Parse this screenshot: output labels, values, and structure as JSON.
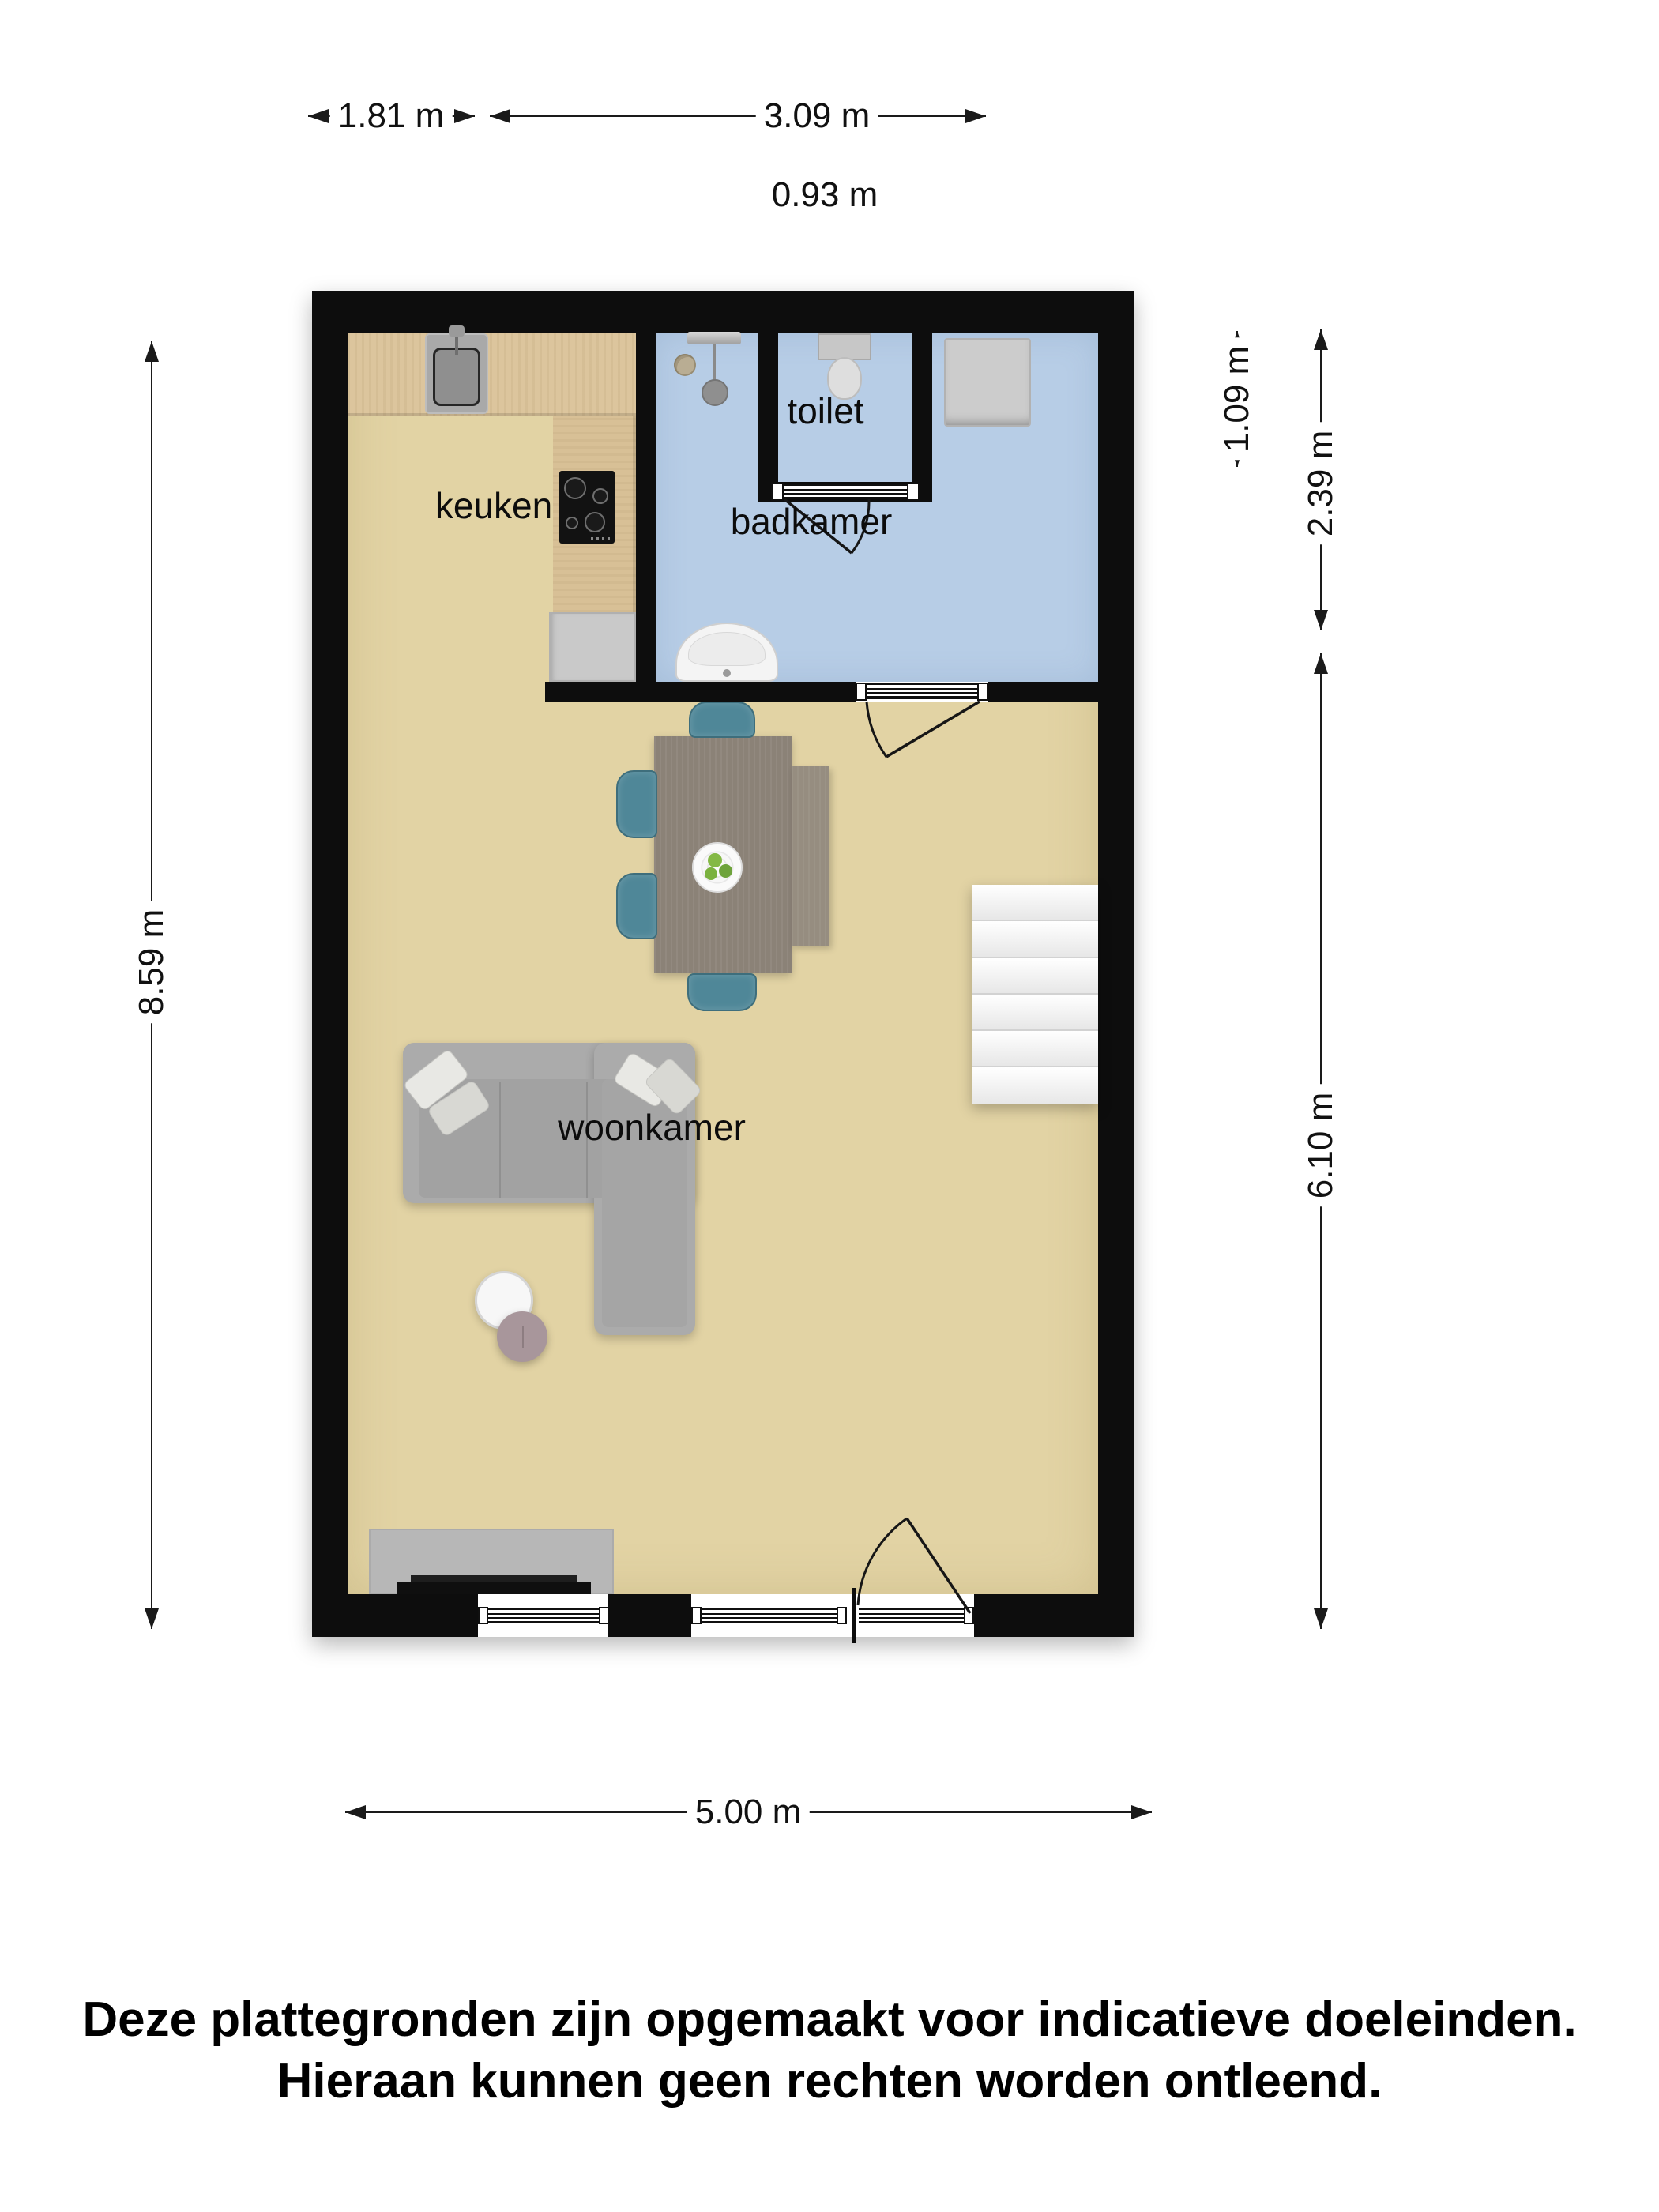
{
  "plan": {
    "rooms": {
      "keuken": {
        "label": "keuken"
      },
      "badkamer": {
        "label": "badkamer"
      },
      "toilet": {
        "label": "toilet"
      },
      "woonkamer": {
        "label": "woonkamer"
      }
    },
    "dimensions": {
      "top_kitchen_width": "1.81 m",
      "top_bathroom_width": "3.09 m",
      "top_toilet_width": "0.93 m",
      "left_total_height": "8.59 m",
      "right_toilet_depth": "1.09 m",
      "right_bathroom_depth": "2.39 m",
      "right_living_height": "6.10 m",
      "bottom_total_width": "5.00 m"
    },
    "stairs_steps": 6,
    "cooktop_burners": 4,
    "colors": {
      "wall": "#0d0d0d",
      "floor_living": "#e2d3a4",
      "floor_bathroom": "#b7cde6",
      "kitchen_counter": "#dcc59d",
      "dining_chair": "#4f8798",
      "sofa": "#ababab",
      "coffee_table_accent": "#a8969b"
    }
  },
  "footer": {
    "line1": "Deze plattegronden zijn opgemaakt voor indicatieve doeleinden.",
    "line2": "Hieraan kunnen geen rechten worden ontleend."
  }
}
